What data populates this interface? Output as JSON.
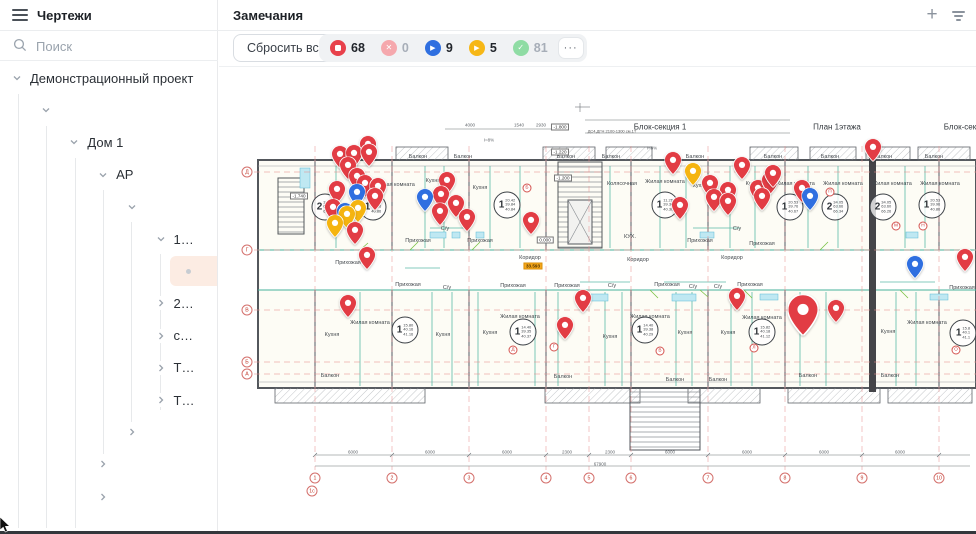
{
  "sidebar": {
    "header": {
      "title": "Чертежи"
    },
    "search": {
      "placeholder": "Поиск"
    },
    "tree": {
      "items": [
        {
          "label": "Демонстрационный проект",
          "indent": 0,
          "chevron": "down",
          "selected": false
        },
        {
          "label": "",
          "indent": 1,
          "chevron": "down",
          "selected": false
        },
        {
          "label": "Дом 1",
          "indent": 2,
          "chevron": "down",
          "selected": false
        },
        {
          "label": "АР",
          "indent": 3,
          "chevron": "down",
          "selected": false
        },
        {
          "label": "",
          "indent": 4,
          "chevron": "down",
          "selected": false
        },
        {
          "label": "1…",
          "indent": 5,
          "chevron": "down",
          "selected": false
        },
        {
          "label": "",
          "indent": 6,
          "chevron": "none",
          "selected": true
        },
        {
          "label": "2…",
          "indent": 5,
          "chevron": "right",
          "selected": false
        },
        {
          "label": "с…",
          "indent": 5,
          "chevron": "right",
          "selected": false
        },
        {
          "label": "Т…",
          "indent": 5,
          "chevron": "right",
          "selected": false
        },
        {
          "label": "Т…",
          "indent": 5,
          "chevron": "right",
          "selected": false
        },
        {
          "label": "",
          "indent": 4,
          "chevron": "right",
          "selected": false
        },
        {
          "label": "",
          "indent": 3,
          "chevron": "right",
          "selected": false
        },
        {
          "label": "",
          "indent": 3,
          "chevron": "right",
          "selected": false
        }
      ],
      "guides": [
        {
          "x": 18,
          "y1": 32,
          "y2": 466
        },
        {
          "x": 46,
          "y1": 64,
          "y2": 466
        },
        {
          "x": 75,
          "y1": 96,
          "y2": 466
        },
        {
          "x": 103,
          "y1": 128,
          "y2": 392
        },
        {
          "x": 131,
          "y1": 160,
          "y2": 360
        },
        {
          "x": 160,
          "y1": 192,
          "y2": 348
        }
      ]
    }
  },
  "remarks": {
    "title": "Замечания",
    "toolbar": {
      "reset_label": "Сбросить все",
      "more_label": "···",
      "chips": [
        {
          "name": "status-stop",
          "icon": "stop",
          "color": "#e8414b",
          "count": "68",
          "active": true
        },
        {
          "name": "status-cancel",
          "icon": "x",
          "color": "#f5a8ad",
          "count": "0",
          "active": false
        },
        {
          "name": "status-play-blue",
          "icon": "play",
          "color": "#2f6fe0",
          "count": "9",
          "active": true
        },
        {
          "name": "status-play-yellow",
          "icon": "play",
          "color": "#f6b716",
          "count": "5",
          "active": true
        },
        {
          "name": "status-check",
          "icon": "check",
          "color": "#8fdca4",
          "count": "81",
          "active": false
        }
      ]
    },
    "header_icons": {
      "add": "+",
      "filter": "filter"
    }
  },
  "plan": {
    "titles": [
      {
        "text": "Блок-секция 1",
        "x": 660,
        "y": 127
      },
      {
        "text": "План 1этажа",
        "x": 837,
        "y": 127
      },
      {
        "text": "Блок-секция 2",
        "x": 970,
        "y": 127
      }
    ],
    "notes": [
      {
        "text": "ДС4,ДГН 2100-1300 см.1Т",
        "x": 612,
        "y": 131
      }
    ],
    "elevations": [
      {
        "t": "-1.800",
        "x": 560,
        "y": 127,
        "box": true,
        "hl": false
      },
      {
        "t": "-1.220",
        "x": 560,
        "y": 152,
        "box": true,
        "hl": false
      },
      {
        "t": "-1.740",
        "x": 299,
        "y": 196,
        "box": true,
        "hl": false
      },
      {
        "t": "-1.200",
        "x": 563,
        "y": 178,
        "box": true,
        "hl": false
      },
      {
        "t": "0.000",
        "x": 545,
        "y": 240,
        "box": true,
        "hl": false
      },
      {
        "t": "33.593",
        "x": 533,
        "y": 266,
        "box": true,
        "hl": true
      }
    ],
    "dims": [
      {
        "t": "4000",
        "x": 470,
        "y": 125
      },
      {
        "t": "1540",
        "x": 519,
        "y": 125
      },
      {
        "t": "2930",
        "x": 541,
        "y": 125
      },
      {
        "t": "I=8%",
        "x": 489,
        "y": 140
      },
      {
        "t": "I=8%",
        "x": 652,
        "y": 148
      },
      {
        "t": "6000",
        "x": 353,
        "y": 452
      },
      {
        "t": "6000",
        "x": 430,
        "y": 452
      },
      {
        "t": "6000",
        "x": 507,
        "y": 452
      },
      {
        "t": "2300",
        "x": 567,
        "y": 452
      },
      {
        "t": "2300",
        "x": 610,
        "y": 452
      },
      {
        "t": "6000",
        "x": 670,
        "y": 452
      },
      {
        "t": "6000",
        "x": 747,
        "y": 452
      },
      {
        "t": "6000",
        "x": 824,
        "y": 452
      },
      {
        "t": "6000",
        "x": 900,
        "y": 452
      },
      {
        "t": "67900",
        "x": 600,
        "y": 464
      }
    ],
    "room_labels": [
      {
        "t": "Балкон",
        "x": 418,
        "y": 157
      },
      {
        "t": "Балкон",
        "x": 463,
        "y": 157
      },
      {
        "t": "Балкон",
        "x": 566,
        "y": 157
      },
      {
        "t": "Балкон",
        "x": 611,
        "y": 157
      },
      {
        "t": "Балкон",
        "x": 695,
        "y": 157
      },
      {
        "t": "Балкон",
        "x": 773,
        "y": 157
      },
      {
        "t": "Балкон",
        "x": 830,
        "y": 157
      },
      {
        "t": "Балкон",
        "x": 883,
        "y": 157
      },
      {
        "t": "Балкон",
        "x": 934,
        "y": 157
      },
      {
        "t": "Жилая комната",
        "x": 395,
        "y": 185
      },
      {
        "t": "Кухня",
        "x": 433,
        "y": 181
      },
      {
        "t": "Кухня",
        "x": 480,
        "y": 188
      },
      {
        "t": "Колясочная",
        "x": 622,
        "y": 184
      },
      {
        "t": "Жилая комната",
        "x": 665,
        "y": 182
      },
      {
        "t": "Кухня",
        "x": 700,
        "y": 186
      },
      {
        "t": "Кухня",
        "x": 753,
        "y": 184
      },
      {
        "t": "Жилая комната",
        "x": 795,
        "y": 184
      },
      {
        "t": "Жилая комната",
        "x": 843,
        "y": 184
      },
      {
        "t": "Жилая комната",
        "x": 892,
        "y": 184
      },
      {
        "t": "Жилая комната",
        "x": 940,
        "y": 184
      },
      {
        "t": "Прихожая",
        "x": 418,
        "y": 241
      },
      {
        "t": "Прихожая",
        "x": 480,
        "y": 241
      },
      {
        "t": "Прихожая",
        "x": 700,
        "y": 241
      },
      {
        "t": "Прихожая",
        "x": 762,
        "y": 244
      },
      {
        "t": "С/у",
        "x": 445,
        "y": 229
      },
      {
        "t": "С/у",
        "x": 737,
        "y": 229
      },
      {
        "t": "КУХ.",
        "x": 630,
        "y": 237
      },
      {
        "t": "Коридор",
        "x": 530,
        "y": 258
      },
      {
        "t": "Коридор",
        "x": 638,
        "y": 260
      },
      {
        "t": "Коридор",
        "x": 732,
        "y": 258
      },
      {
        "t": "Прихожая",
        "x": 348,
        "y": 263
      },
      {
        "t": "Прихожая",
        "x": 408,
        "y": 285
      },
      {
        "t": "Прихожая",
        "x": 513,
        "y": 286
      },
      {
        "t": "Прихожая",
        "x": 567,
        "y": 286
      },
      {
        "t": "Прихожая",
        "x": 667,
        "y": 285
      },
      {
        "t": "Прихожая",
        "x": 750,
        "y": 285
      },
      {
        "t": "Прихожая",
        "x": 962,
        "y": 288
      },
      {
        "t": "С/у",
        "x": 612,
        "y": 286
      },
      {
        "t": "С/у",
        "x": 693,
        "y": 287
      },
      {
        "t": "С/у",
        "x": 718,
        "y": 287
      },
      {
        "t": "С/у",
        "x": 447,
        "y": 288
      },
      {
        "t": "Жилая комната",
        "x": 370,
        "y": 323
      },
      {
        "t": "Жилая комната",
        "x": 520,
        "y": 317
      },
      {
        "t": "Жилая комната",
        "x": 650,
        "y": 317
      },
      {
        "t": "Жилая комната",
        "x": 762,
        "y": 318
      },
      {
        "t": "Жилая комната",
        "x": 927,
        "y": 323
      },
      {
        "t": "Кухня",
        "x": 332,
        "y": 335
      },
      {
        "t": "Кухня",
        "x": 443,
        "y": 335
      },
      {
        "t": "Кухня",
        "x": 490,
        "y": 333
      },
      {
        "t": "Кухня",
        "x": 610,
        "y": 337
      },
      {
        "t": "Кухня",
        "x": 685,
        "y": 333
      },
      {
        "t": "Кухня",
        "x": 728,
        "y": 333
      },
      {
        "t": "Кухня",
        "x": 888,
        "y": 332
      },
      {
        "t": "Балкон",
        "x": 330,
        "y": 376
      },
      {
        "t": "Балкон",
        "x": 563,
        "y": 377
      },
      {
        "t": "Балкон",
        "x": 675,
        "y": 380
      },
      {
        "t": "Балкон",
        "x": 718,
        "y": 380
      },
      {
        "t": "Балкон",
        "x": 808,
        "y": 376
      },
      {
        "t": "Балкон",
        "x": 890,
        "y": 376
      }
    ],
    "apartments": [
      {
        "n": "2",
        "areas": [
          "34.05",
          "63.66",
          "66.26"
        ],
        "x": 325,
        "y": 207
      },
      {
        "n": "1",
        "areas": [
          "20.42",
          "39.86",
          "40.86"
        ],
        "x": 373,
        "y": 207
      },
      {
        "n": "1",
        "areas": [
          "20.42",
          "39.84",
          "40.84"
        ],
        "x": 507,
        "y": 205
      },
      {
        "n": "1",
        "areas": [
          "11.26",
          "39.36",
          "40.36"
        ],
        "x": 665,
        "y": 205
      },
      {
        "n": "1",
        "areas": [
          "20.53",
          "39.76",
          "40.67"
        ],
        "x": 790,
        "y": 207
      },
      {
        "n": "2",
        "areas": [
          "34.05",
          "63.66",
          "66.34"
        ],
        "x": 835,
        "y": 207
      },
      {
        "n": "2",
        "areas": [
          "34.05",
          "63.60",
          "66.26"
        ],
        "x": 883,
        "y": 207
      },
      {
        "n": "1",
        "areas": [
          "20.53",
          "39.96",
          "40.86"
        ],
        "x": 932,
        "y": 205
      },
      {
        "n": "1",
        "areas": [
          "15.80",
          "40.16",
          "41.16"
        ],
        "x": 405,
        "y": 330
      },
      {
        "n": "1",
        "areas": [
          "14.40",
          "39.35",
          "40.37"
        ],
        "x": 523,
        "y": 332
      },
      {
        "n": "1",
        "areas": [
          "14.40",
          "39.38",
          "40.29"
        ],
        "x": 645,
        "y": 330
      },
      {
        "n": "1",
        "areas": [
          "15.82",
          "40.18",
          "41.12"
        ],
        "x": 762,
        "y": 332
      },
      {
        "n": "1",
        "areas": [
          "15.8",
          "40.1",
          "41.1"
        ],
        "x": 963,
        "y": 333
      }
    ],
    "letters": [
      {
        "t": "Б",
        "x": 527,
        "y": 188
      },
      {
        "t": "И",
        "x": 811,
        "y": 192
      },
      {
        "t": "П",
        "x": 830,
        "y": 192
      },
      {
        "t": "М",
        "x": 896,
        "y": 226
      },
      {
        "t": "Н",
        "x": 923,
        "y": 226
      },
      {
        "t": "Д",
        "x": 513,
        "y": 350
      },
      {
        "t": "Г",
        "x": 554,
        "y": 347
      },
      {
        "t": "В",
        "x": 660,
        "y": 351
      },
      {
        "t": "Л",
        "x": 754,
        "y": 348
      },
      {
        "t": "О",
        "x": 956,
        "y": 350
      }
    ],
    "axes_bottom": [
      {
        "t": "1",
        "x": 315,
        "y": 478
      },
      {
        "t": "1с",
        "x": 312,
        "y": 491
      },
      {
        "t": "2",
        "x": 392,
        "y": 478
      },
      {
        "t": "3",
        "x": 469,
        "y": 478
      },
      {
        "t": "4",
        "x": 546,
        "y": 478
      },
      {
        "t": "5",
        "x": 589,
        "y": 478
      },
      {
        "t": "6",
        "x": 631,
        "y": 478
      },
      {
        "t": "7",
        "x": 708,
        "y": 478
      },
      {
        "t": "8",
        "x": 785,
        "y": 478
      },
      {
        "t": "9",
        "x": 862,
        "y": 478
      },
      {
        "t": "10",
        "x": 939,
        "y": 478
      }
    ],
    "axes_left": [
      {
        "t": "Д",
        "x": 247,
        "y": 172
      },
      {
        "t": "Г",
        "x": 247,
        "y": 250
      },
      {
        "t": "В",
        "x": 247,
        "y": 310
      },
      {
        "t": "Б",
        "x": 247,
        "y": 362
      },
      {
        "t": "А",
        "x": 247,
        "y": 374
      }
    ],
    "pins": [
      {
        "x": 368,
        "y": 151,
        "c": "red"
      },
      {
        "x": 340,
        "y": 161,
        "c": "red"
      },
      {
        "x": 354,
        "y": 160,
        "c": "red"
      },
      {
        "x": 369,
        "y": 159,
        "c": "red"
      },
      {
        "x": 348,
        "y": 172,
        "c": "red"
      },
      {
        "x": 357,
        "y": 183,
        "c": "red"
      },
      {
        "x": 337,
        "y": 196,
        "c": "red"
      },
      {
        "x": 365,
        "y": 190,
        "c": "red"
      },
      {
        "x": 378,
        "y": 193,
        "c": "red"
      },
      {
        "x": 375,
        "y": 203,
        "c": "red"
      },
      {
        "x": 333,
        "y": 214,
        "c": "red"
      },
      {
        "x": 357,
        "y": 199,
        "c": "blue"
      },
      {
        "x": 345,
        "y": 218,
        "c": "blue"
      },
      {
        "x": 358,
        "y": 215,
        "c": "yellow"
      },
      {
        "x": 347,
        "y": 221,
        "c": "yellow"
      },
      {
        "x": 335,
        "y": 230,
        "c": "yellow"
      },
      {
        "x": 355,
        "y": 237,
        "c": "red"
      },
      {
        "x": 367,
        "y": 262,
        "c": "red"
      },
      {
        "x": 348,
        "y": 310,
        "c": "red"
      },
      {
        "x": 447,
        "y": 187,
        "c": "red"
      },
      {
        "x": 441,
        "y": 201,
        "c": "red"
      },
      {
        "x": 425,
        "y": 204,
        "c": "blue"
      },
      {
        "x": 456,
        "y": 210,
        "c": "red"
      },
      {
        "x": 440,
        "y": 218,
        "c": "red"
      },
      {
        "x": 467,
        "y": 224,
        "c": "red"
      },
      {
        "x": 531,
        "y": 227,
        "c": "red"
      },
      {
        "x": 583,
        "y": 305,
        "c": "red"
      },
      {
        "x": 565,
        "y": 332,
        "c": "red"
      },
      {
        "x": 673,
        "y": 167,
        "c": "red"
      },
      {
        "x": 693,
        "y": 178,
        "c": "yellow"
      },
      {
        "x": 710,
        "y": 190,
        "c": "red"
      },
      {
        "x": 728,
        "y": 197,
        "c": "red"
      },
      {
        "x": 742,
        "y": 172,
        "c": "red"
      },
      {
        "x": 714,
        "y": 204,
        "c": "red"
      },
      {
        "x": 728,
        "y": 208,
        "c": "red"
      },
      {
        "x": 758,
        "y": 195,
        "c": "red"
      },
      {
        "x": 770,
        "y": 187,
        "c": "red"
      },
      {
        "x": 773,
        "y": 180,
        "c": "red"
      },
      {
        "x": 680,
        "y": 212,
        "c": "red"
      },
      {
        "x": 762,
        "y": 203,
        "c": "red"
      },
      {
        "x": 737,
        "y": 303,
        "c": "red"
      },
      {
        "x": 873,
        "y": 154,
        "c": "red"
      },
      {
        "x": 802,
        "y": 195,
        "c": "red"
      },
      {
        "x": 810,
        "y": 203,
        "c": "blue"
      },
      {
        "x": 915,
        "y": 271,
        "c": "blue"
      },
      {
        "x": 965,
        "y": 264,
        "c": "red"
      },
      {
        "x": 836,
        "y": 315,
        "c": "red"
      },
      {
        "x": 803,
        "y": 320,
        "c": "red",
        "s": 1.8
      }
    ]
  },
  "colors": {
    "pin_red": "#e23c44",
    "pin_blue": "#2f6fe0",
    "pin_yellow": "#f5b40f",
    "chip_inactive_text": "#a7aeb8",
    "chip_active_text": "#22262c",
    "selected_row_bg": "#fcece3"
  }
}
